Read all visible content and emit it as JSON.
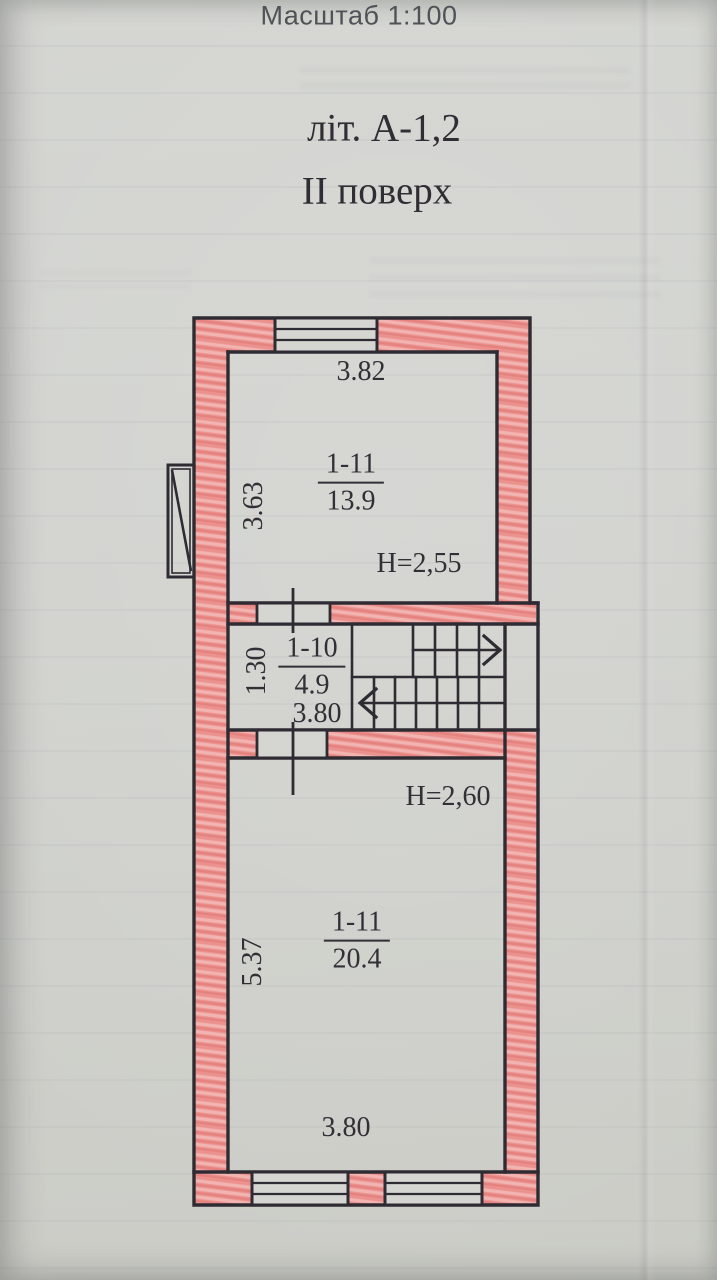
{
  "document": {
    "scale_label": "Масштаб 1:100",
    "building_letter": "літ. А-1,2",
    "floor_title": "ІІ поверх"
  },
  "rooms": {
    "upper": {
      "number": "1-11",
      "area": "13.9",
      "ceiling_height": "H=2,55",
      "top_dim": "3.82",
      "side_dim": "3.63"
    },
    "hall": {
      "number": "1-10",
      "area": "4.9",
      "bottom_dim": "3.80",
      "side_dim": "1.30"
    },
    "lower": {
      "number": "1-11",
      "area": "20.4",
      "ceiling_height": "H=2,60",
      "bottom_dim": "3.80",
      "side_dim": "5.37"
    }
  },
  "colors": {
    "paper": "#d2d3cf",
    "ink": "#2f2b33",
    "wall_hatch": "#eb928f"
  }
}
